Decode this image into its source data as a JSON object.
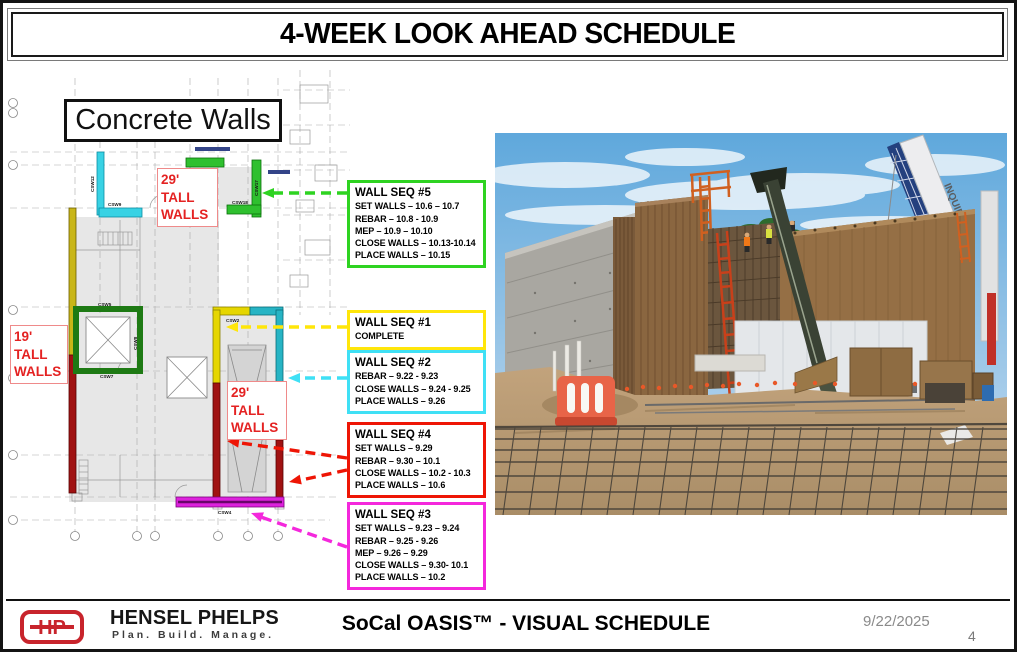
{
  "slide": {
    "title": "4-WEEK LOOK AHEAD SCHEDULE"
  },
  "plan": {
    "heading": "Concrete Walls",
    "labels": {
      "tall29_top": "29' TALL WALLS",
      "tall19": "19' TALL WALLS",
      "tall29_mid": "29' TALL WALLS"
    },
    "wall_tags": {
      "csw12": "CSW12",
      "csw9": "CSW9",
      "csw13": "CSW13",
      "csw17": "CSW17",
      "csw18": "CSW18",
      "csw5": "CSW5",
      "csw6": "CSW6",
      "csw7": "CSW7",
      "csw8": "CSW8",
      "csw2": "CSW2",
      "csw4": "CSW4"
    },
    "wall_colors": {
      "cyan": "#38d2e4",
      "bright_green": "#2fc02f",
      "olive_yellow": "#c9b618",
      "dark_green": "#1e7a14",
      "dark_red": "#a01212",
      "yellow": "#e6d600",
      "teal": "#27b4c4",
      "magenta": "#dd22dd"
    }
  },
  "callouts": [
    {
      "id": "seq5",
      "title": "WALL SEQ #5",
      "color": "#2ed321",
      "lines": [
        "SET WALLS – 10.6 – 10.7",
        "REBAR – 10.8 - 10.9",
        "MEP – 10.9 – 10.10",
        "CLOSE WALLS – 10.13-10.14",
        "PLACE WALLS – 10.15"
      ]
    },
    {
      "id": "seq1",
      "title": "WALL SEQ #1",
      "color": "#ffe60a",
      "lines": [
        "COMPLETE"
      ]
    },
    {
      "id": "seq2",
      "title": "WALL SEQ #2",
      "color": "#3fe0f5",
      "lines": [
        "REBAR – 9.22 - 9.23",
        "CLOSE WALLS – 9.24 - 9.25",
        "PLACE WALLS – 9.26"
      ]
    },
    {
      "id": "seq4",
      "title": "WALL SEQ #4",
      "color": "#ee1505",
      "lines": [
        "SET WALLS – 9.29",
        "REBAR – 9.30 – 10.1",
        "CLOSE WALLS – 10.2 - 10.3",
        "PLACE WALLS – 10.6"
      ]
    },
    {
      "id": "seq3",
      "title": "WALL SEQ #3",
      "color": "#f428dc",
      "lines": [
        "SET WALLS – 9.23 – 9.24",
        "REBAR – 9.25 - 9.26",
        "MEP – 9.26 – 9.29",
        "CLOSE WALLS – 9.30- 10.1",
        "PLACE WALLS – 10.2"
      ]
    }
  ],
  "photo": {
    "crane_text": "INQUIPCO"
  },
  "footer": {
    "logo_monogram": "HP",
    "company": "HENSEL PHELPS",
    "tagline": "Plan. Build. Manage.",
    "project_title": "SoCal OASIS™ - VISUAL SCHEDULE",
    "date": "9/22/2025",
    "page_number": "4",
    "brand_red": "#c8242c"
  }
}
